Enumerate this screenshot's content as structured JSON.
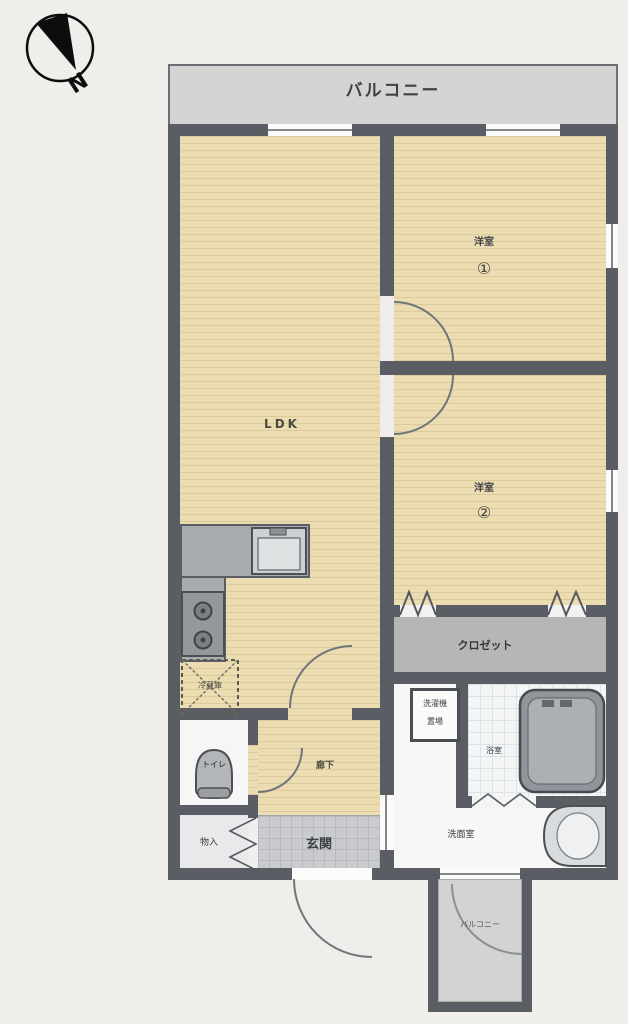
{
  "compass": {
    "north_label": "N"
  },
  "labels": {
    "balcony_top": "バルコニー",
    "ldk": "LDK",
    "bedroom1_name": "洋室",
    "bedroom1_no": "①",
    "bedroom2_name": "洋室",
    "bedroom2_no": "②",
    "closet": "クロゼット",
    "refrigerator": "冷蔵庫",
    "toilet": "トイレ",
    "hallway": "廊下",
    "storage": "物入",
    "entrance": "玄関",
    "laundry_line1": "洗濯機",
    "laundry_line2": "置場",
    "bathroom": "浴室",
    "washroom": "洗面室",
    "balcony_bottom": "バルコニー"
  },
  "colors": {
    "wall": "#5a5e64",
    "room_floor": "#ecdcb2",
    "balcony": "#d4d4d4",
    "closet": "#b6b6b6",
    "genkan_tile": "#c9cbce",
    "counter": "#a9acaf"
  }
}
